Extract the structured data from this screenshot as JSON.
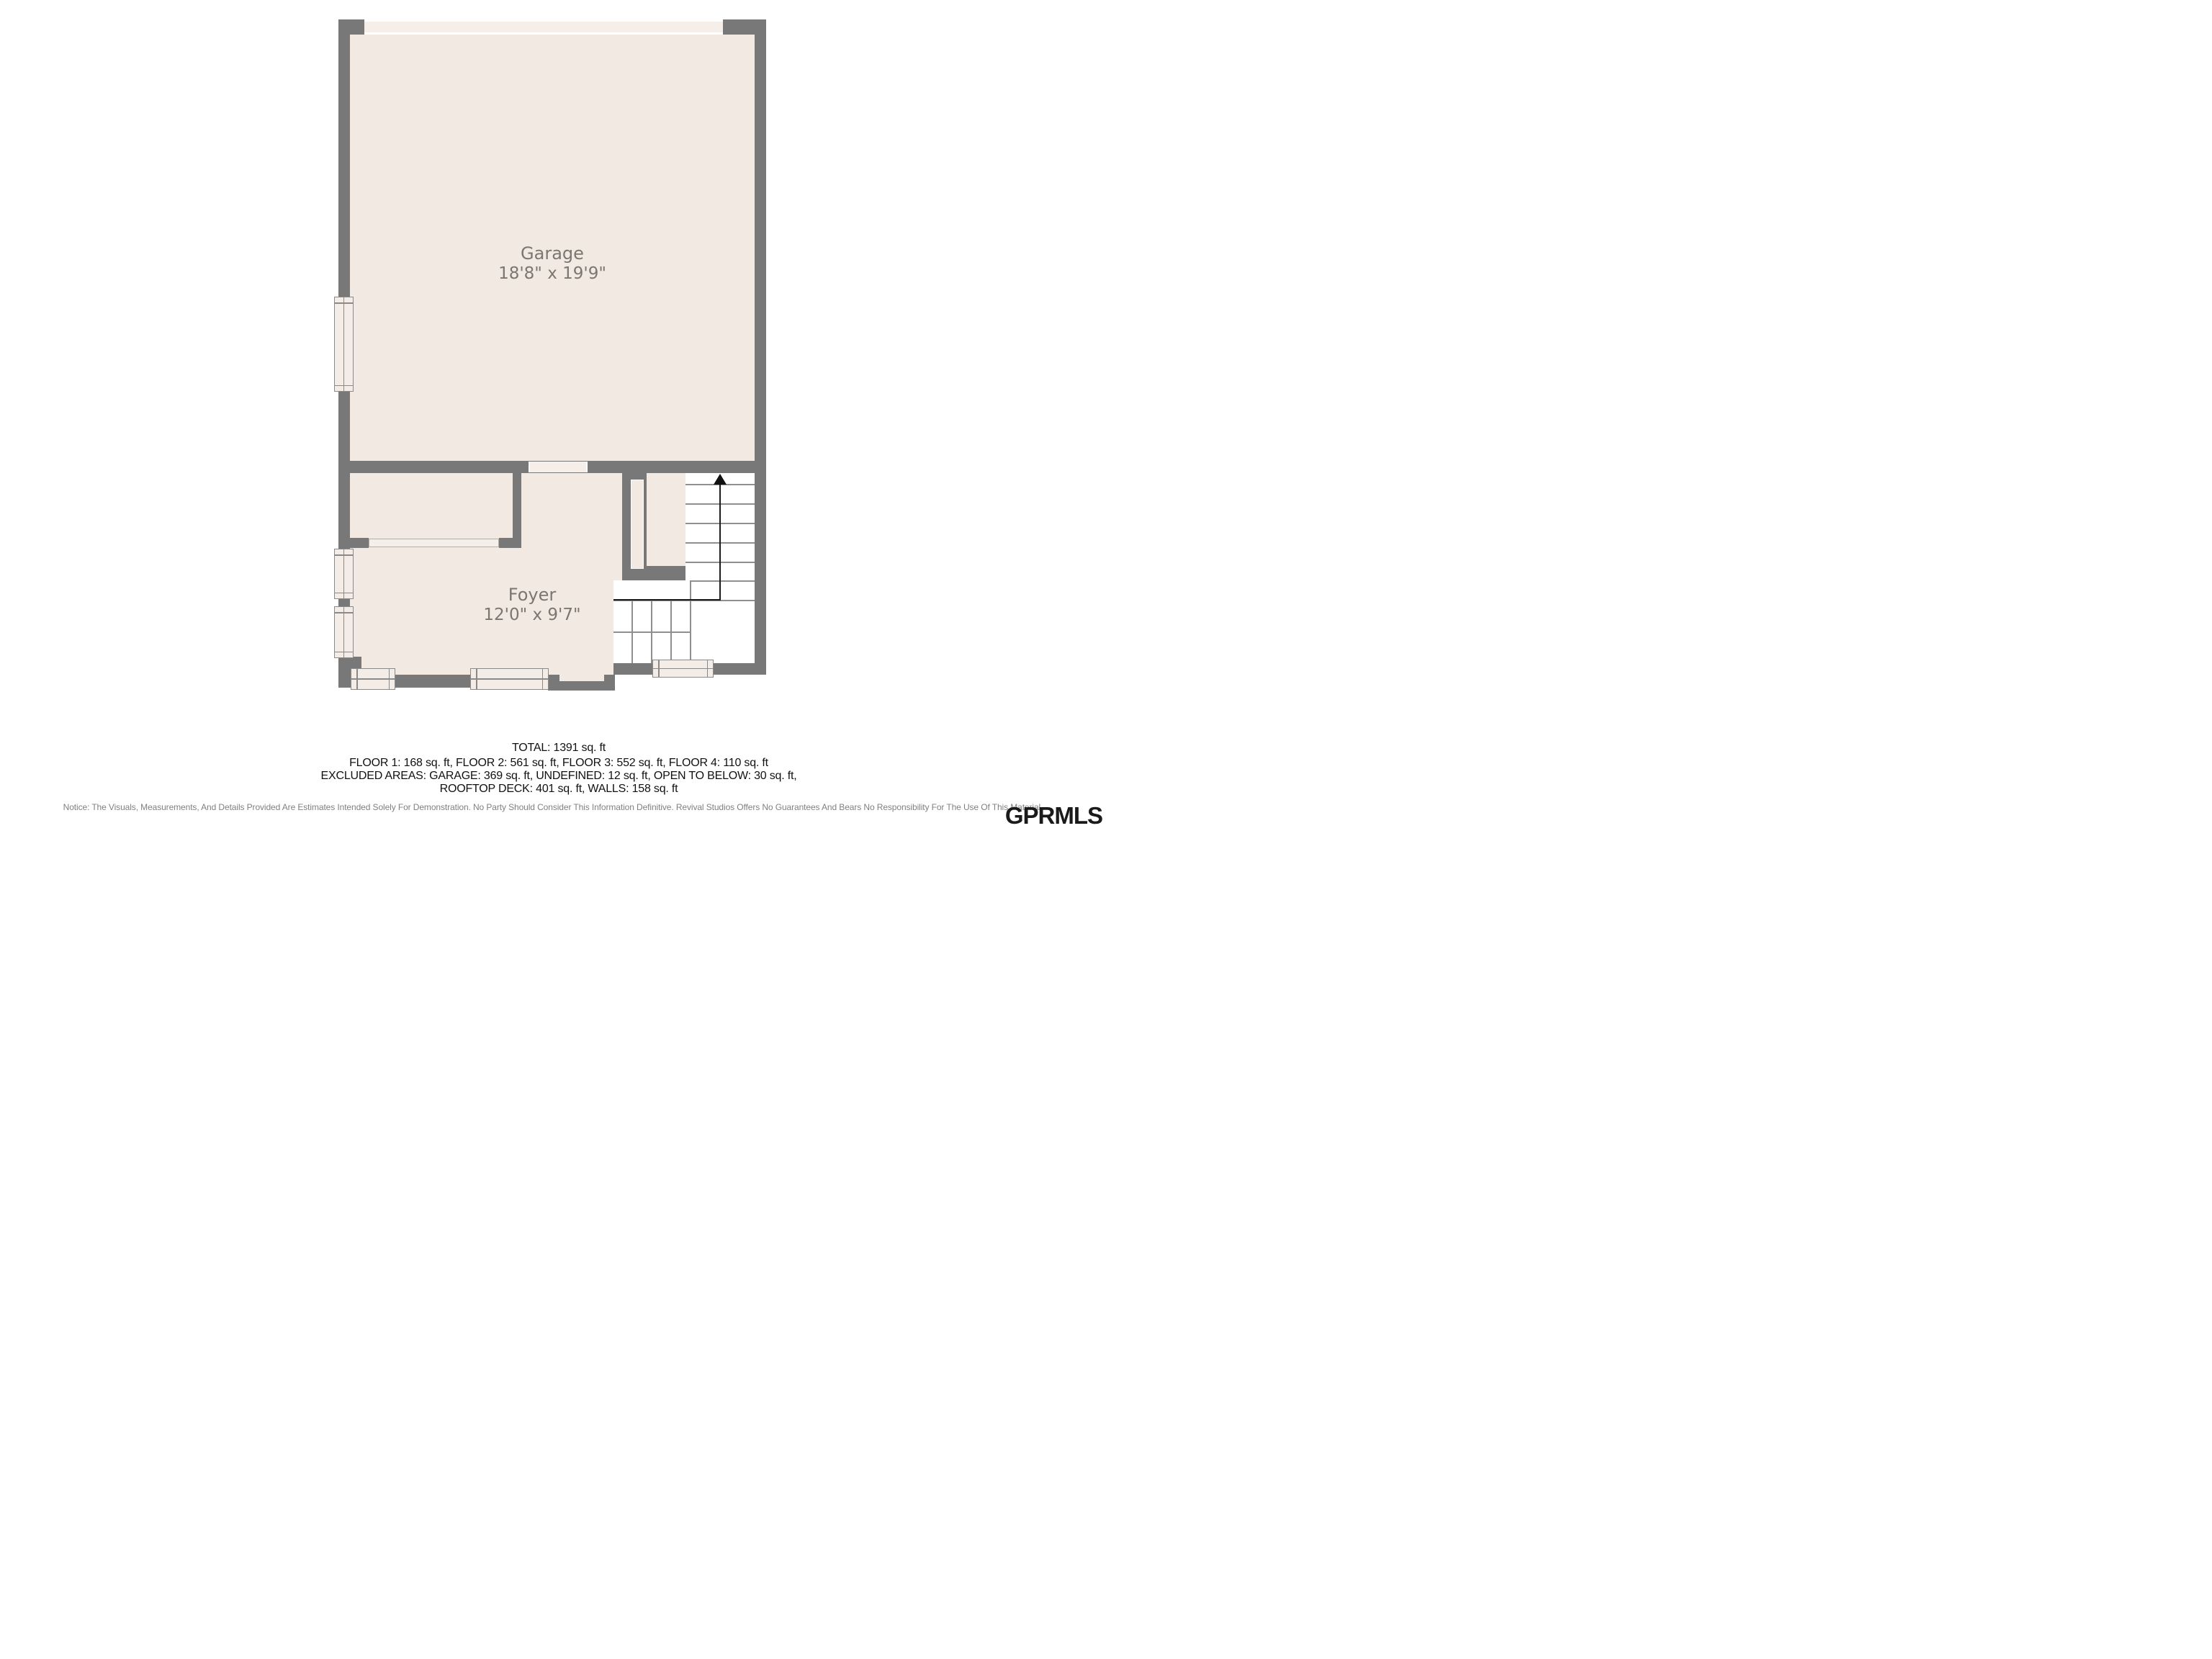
{
  "plan": {
    "rooms": [
      {
        "name": "Garage",
        "dims": "18'8\" x 19'9\""
      },
      {
        "name": "Foyer",
        "dims": "12'0\" x 9'7\""
      }
    ],
    "features": {
      "stairs_direction": "up",
      "garage_door": "garage-door-opening",
      "entry_door": "front-entry-door",
      "windows": [
        "garage-left-window",
        "foyer-left-upper-window",
        "foyer-left-lower-window",
        "foyer-bottom-small-window",
        "foyer-bottom-wide-window",
        "stair-bottom-window"
      ]
    },
    "colors": {
      "wall": "#787878",
      "floor": "#f2e9e3",
      "opening_band": "#f6efe9",
      "stair_fill": "#ffffff",
      "stair_line": "#8f8f8f",
      "path_line": "#1c1c1c",
      "label_text": "#7b7670"
    }
  },
  "summary": {
    "total": "TOTAL: 1391 sq. ft",
    "line2": "FLOOR 1: 168 sq. ft, FLOOR 2: 561 sq. ft, FLOOR 3: 552 sq. ft, FLOOR 4: 110 sq. ft",
    "line3": "EXCLUDED AREAS: GARAGE: 369 sq. ft, UNDEFINED: 12 sq. ft, OPEN TO BELOW: 30 sq. ft,",
    "line4": "ROOFTOP DECK: 401 sq. ft, WALLS: 158 sq. ft"
  },
  "footer": {
    "notice": "Notice: The Visuals, Measurements, And Details Provided Are Estimates Intended Solely For Demonstration. No Party Should Consider This Information Definitive. Revival Studios Offers No Guarantees And Bears No Responsibility For The Use Of This Material.",
    "logo": "GPRMLS"
  }
}
